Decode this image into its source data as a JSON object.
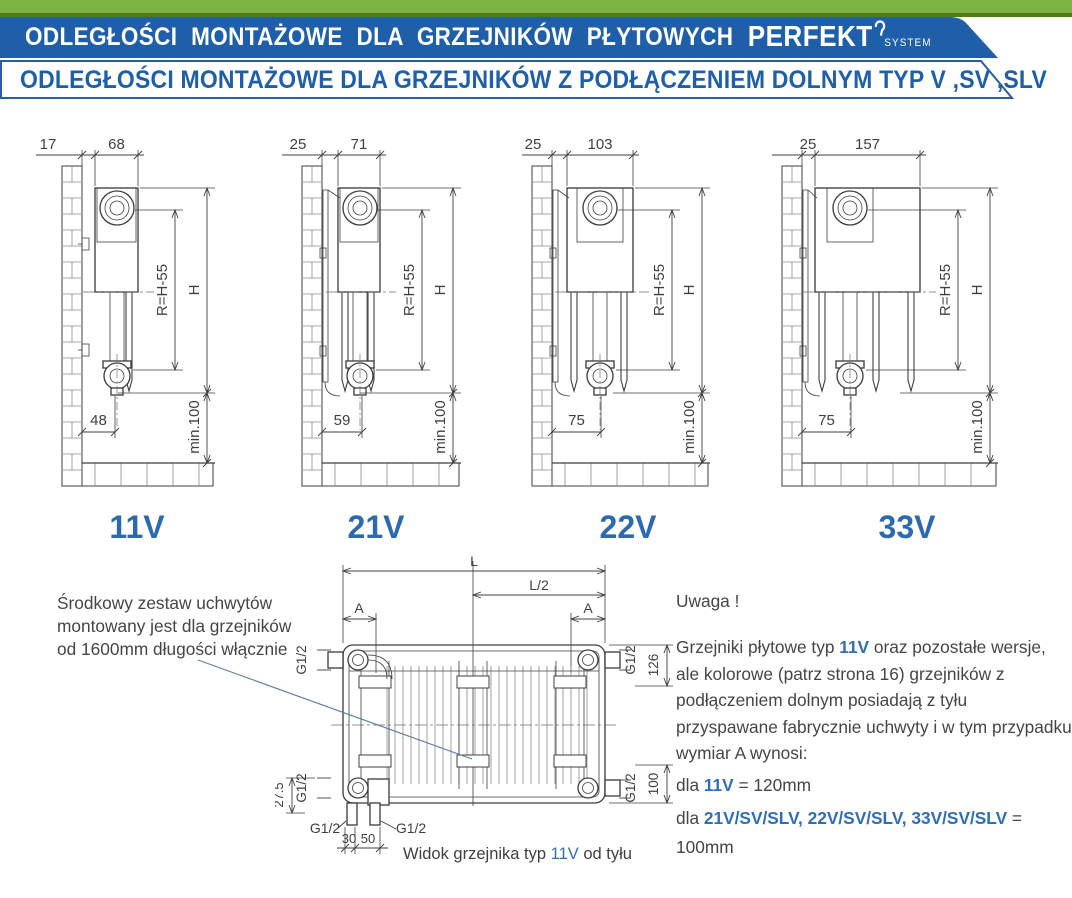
{
  "header": {
    "title": "ODLEGŁOŚCI MONTAŻOWE DLA GRZEJNIKÓW PŁYTOWYCH",
    "brand": "PERFEKT",
    "brand_suffix": "SYSTEM",
    "subtitle": "ODLEGŁOŚCI MONTAŻOWE DLA GRZEJNIKÓW Z PODŁĄCZENIEM DOLNYM TYP V ,SV ,SLV"
  },
  "colors": {
    "banner_blue": "#1f5ea9",
    "green": "#7cb342",
    "dark_green": "#4f7b1f",
    "highlight_blue": "#2f6eb5",
    "label_blue": "#2b6ab1"
  },
  "diagrams": [
    {
      "label": "11V",
      "wall_offset": "17",
      "depth": "68",
      "radius": "R=H-55",
      "height": "H",
      "bottom_offset": "48",
      "floor_clearance": "min.100"
    },
    {
      "label": "21V",
      "wall_offset": "25",
      "depth": "71",
      "radius": "R=H-55",
      "height": "H",
      "bottom_offset": "59",
      "floor_clearance": "min.100"
    },
    {
      "label": "22V",
      "wall_offset": "25",
      "depth": "103",
      "radius": "R=H-55",
      "height": "H",
      "bottom_offset": "75",
      "floor_clearance": "min.100"
    },
    {
      "label": "33V",
      "wall_offset": "25",
      "depth": "157",
      "radius": "R=H-55",
      "height": "H",
      "bottom_offset": "75",
      "floor_clearance": "min.100"
    }
  ],
  "rear": {
    "l": "L",
    "l2": "L/2",
    "a": "A",
    "g12": "G1/2",
    "d126": "126",
    "d100": "100",
    "d275": "27.5",
    "d30": "30",
    "d50": "50",
    "caption_prefix": "Widok grzejnika typ ",
    "caption_type": "11V",
    "caption_suffix": " od tyłu"
  },
  "notes": {
    "left": "Środkowy zestaw uchwytów montowany jest dla grzejników od 1600mm długości włącznie",
    "warning_title": "Uwaga !",
    "warning": [
      {
        "t": "Grzejniki płytowe typ "
      },
      {
        "t": "11V",
        "b": true
      },
      {
        "t": " oraz pozostałe wersje, ale kolorowe (patrz strona 16) grzejników z podłączeniem dolnym posiadają z tyłu przyspawane fabrycznie uchwyty i w tym przypadku wymiar A wynosi:"
      }
    ],
    "case1": [
      {
        "t": "dla "
      },
      {
        "t": "11V",
        "b": true
      },
      {
        "t": " = 120mm"
      }
    ],
    "case2": [
      {
        "t": "dla "
      },
      {
        "t": "21V/SV/SLV, 22V/SV/SLV, 33V/SV/SLV",
        "b": true
      },
      {
        "t": " = 100mm"
      }
    ]
  }
}
